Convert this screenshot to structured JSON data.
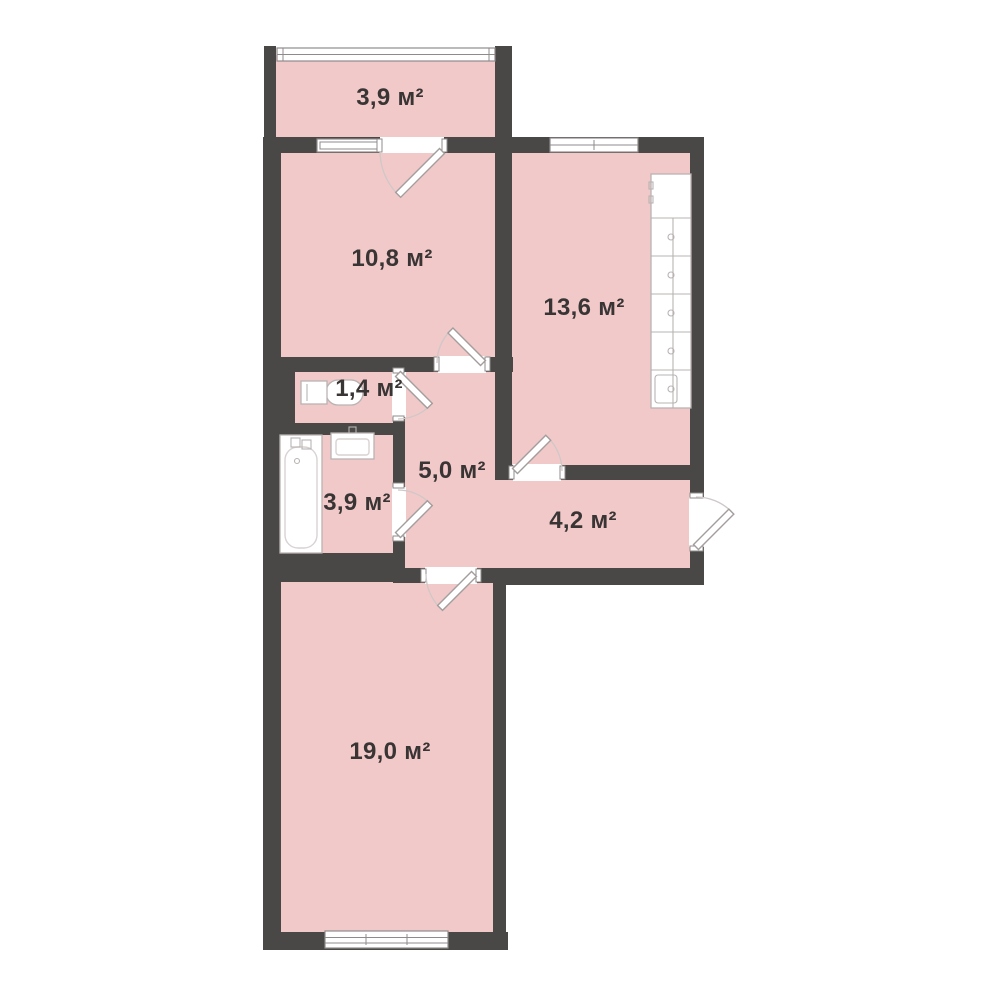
{
  "plan": {
    "type": "apartment-floor-plan",
    "rooms": [
      {
        "id": "balcony",
        "area_label": "3,9 м²"
      },
      {
        "id": "room-10-8",
        "area_label": "10,8 м²"
      },
      {
        "id": "kitchen",
        "area_label": "13,6 м²"
      },
      {
        "id": "wc",
        "area_label": "1,4 м²"
      },
      {
        "id": "hallway",
        "area_label": "5,0 м²"
      },
      {
        "id": "bathroom",
        "area_label": "3,9 м²"
      },
      {
        "id": "entry-hall",
        "area_label": "4,2 м²"
      },
      {
        "id": "living-room",
        "area_label": "19,0 м²"
      }
    ],
    "fixtures": [
      "toilet",
      "bathtub",
      "wash-basin",
      "kitchen-units",
      "entrance-door"
    ]
  },
  "colors": {
    "room_fill": "#f2c9c9",
    "wall_color": "#4a4747",
    "outline": "#8f8b8b",
    "fixture_stroke": "#b9b3b3",
    "inner_stroke": "#d9d2d2",
    "leaf_stroke": "#a39d9d",
    "arc_color": "#cfc8c8",
    "label_color": "#3a3535"
  }
}
